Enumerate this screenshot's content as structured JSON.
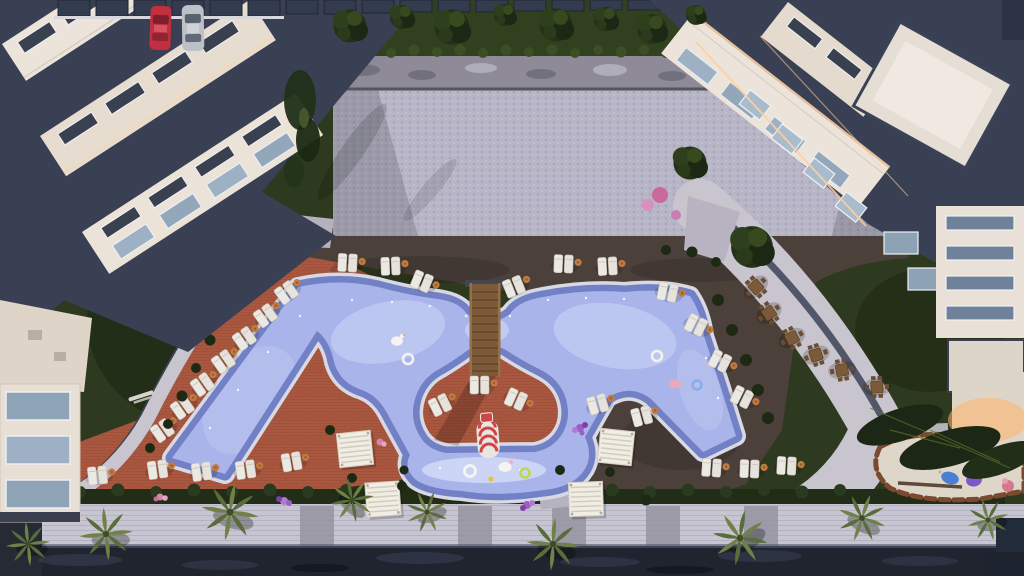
{
  "scene": {
    "title": "Aerial render of residential resort courtyard",
    "aria_label": "Top-down 3D architectural rendering of an apartment complex courtyard with a freeform lagoon swimming pool, children's pool with water slide, wooden pool bridge, sun loungers with orange side tables, white pergolas, cafe terrace, palm trees, lawns, a paved plaza and parked cars",
    "type": "aerial-architectural-render"
  },
  "palette": {
    "lawn": "#2e3a1f",
    "lawn_dark": "#19230f",
    "plaza": "#b7b5c6",
    "plaza_wall": "#4e505b",
    "deck_dark": "#4c403b",
    "terracotta": "#a9573f",
    "pool_water": "#a9b5ea",
    "pool_border": "#7280c6",
    "pool_edge": "#d8d9e3",
    "kids_water": "#dfe6fb",
    "bridge_wood": "#7d5a38",
    "lounger": "#ebe9e3",
    "umbrella": "#c07a42",
    "cafe_wood": "#7a5a38",
    "path_light": "#c8c5cf",
    "curb_navy": "#3d4257",
    "building_cream": "#ece4da",
    "roof_navy": "#3a4053",
    "glass": "#9db0c4",
    "led_warm": "#ffcf9e",
    "car_red": "#c23040",
    "car_silver": "#bcc1c8",
    "canopy_dark": "#333b4e",
    "conifer": "#243119",
    "palm_green": "#6f8147",
    "hedge": "#222d18",
    "promenade": "#c7c5d1",
    "water_channel": "#20242f",
    "pebble": "#ded7c9",
    "sand_border": "#7a4a2e",
    "flower_purple": "#9a5fc2",
    "flower_pink": "#d487ae",
    "toy_blue": "#4a7fd4",
    "toy_purple": "#7e58c8",
    "toy_pink": "#d4788c"
  },
  "inventory": {
    "pools": [
      "main-lagoon-pool",
      "kids-pool"
    ],
    "sun_lounger_pairs": 31,
    "cafe_table_sets": 6,
    "pergolas": 4,
    "palm_trees": 9,
    "parked_cars": [
      "red-car",
      "silver-car"
    ],
    "features": [
      "wooden-pool-bridge",
      "water-slide",
      "pool-floats",
      "playground",
      "carport-canopy",
      "paved-plaza",
      "promenade"
    ]
  }
}
